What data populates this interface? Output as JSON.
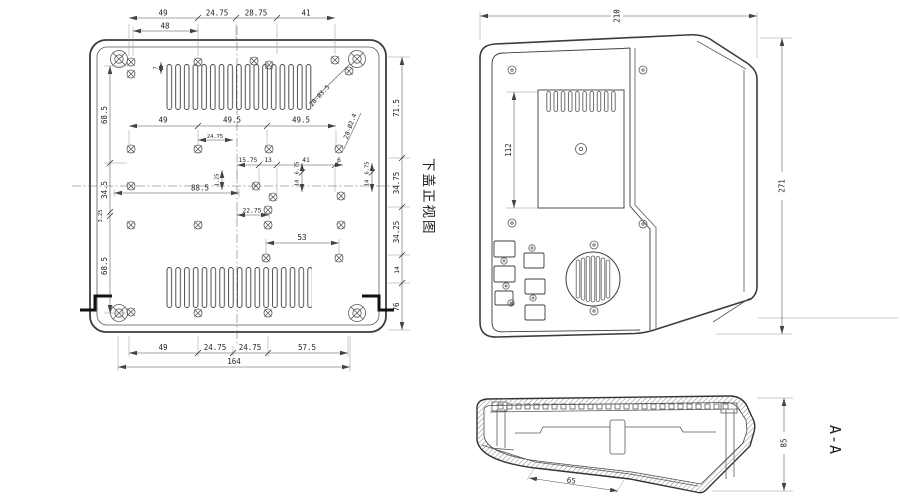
{
  "views": {
    "cover": {
      "title": "下盖正视图",
      "callouts": {
        "c1": "28-Ø3.5",
        "c2": "28-Ø2.4"
      },
      "dims": {
        "top1": [
          "49",
          "24.75",
          "28.75",
          "41"
        ],
        "top2": "48",
        "mid1": [
          "49",
          "49.5",
          "49.5"
        ],
        "mid1_small": "24.75",
        "mid2": [
          "15.75",
          "13",
          "41",
          "6"
        ],
        "width_left": "88.5",
        "tiny_v": "1.25",
        "offset1": "22.75",
        "offset2": "53",
        "bottom1": [
          "49",
          "24.75",
          "24.75",
          "57.5"
        ],
        "total_width": "164",
        "left": [
          "68.5",
          "34.5",
          "3.25",
          "68.5"
        ],
        "left_tiny": "7",
        "right": [
          "71.5",
          "34.75",
          "34.25",
          "14",
          "76"
        ],
        "right_small_a": [
          "6.75",
          "14"
        ],
        "right_small_b": [
          "6.75",
          "14"
        ]
      }
    },
    "front": {
      "dims": {
        "width": "210",
        "height": "271",
        "screen": "112"
      }
    },
    "section": {
      "label": "A-A",
      "dims": {
        "height": "85",
        "slant": "65"
      }
    }
  },
  "colors": {
    "line": "#3c3c3c",
    "dim": "#4f4f4f",
    "text": "#222222",
    "bg": "#ffffff"
  }
}
